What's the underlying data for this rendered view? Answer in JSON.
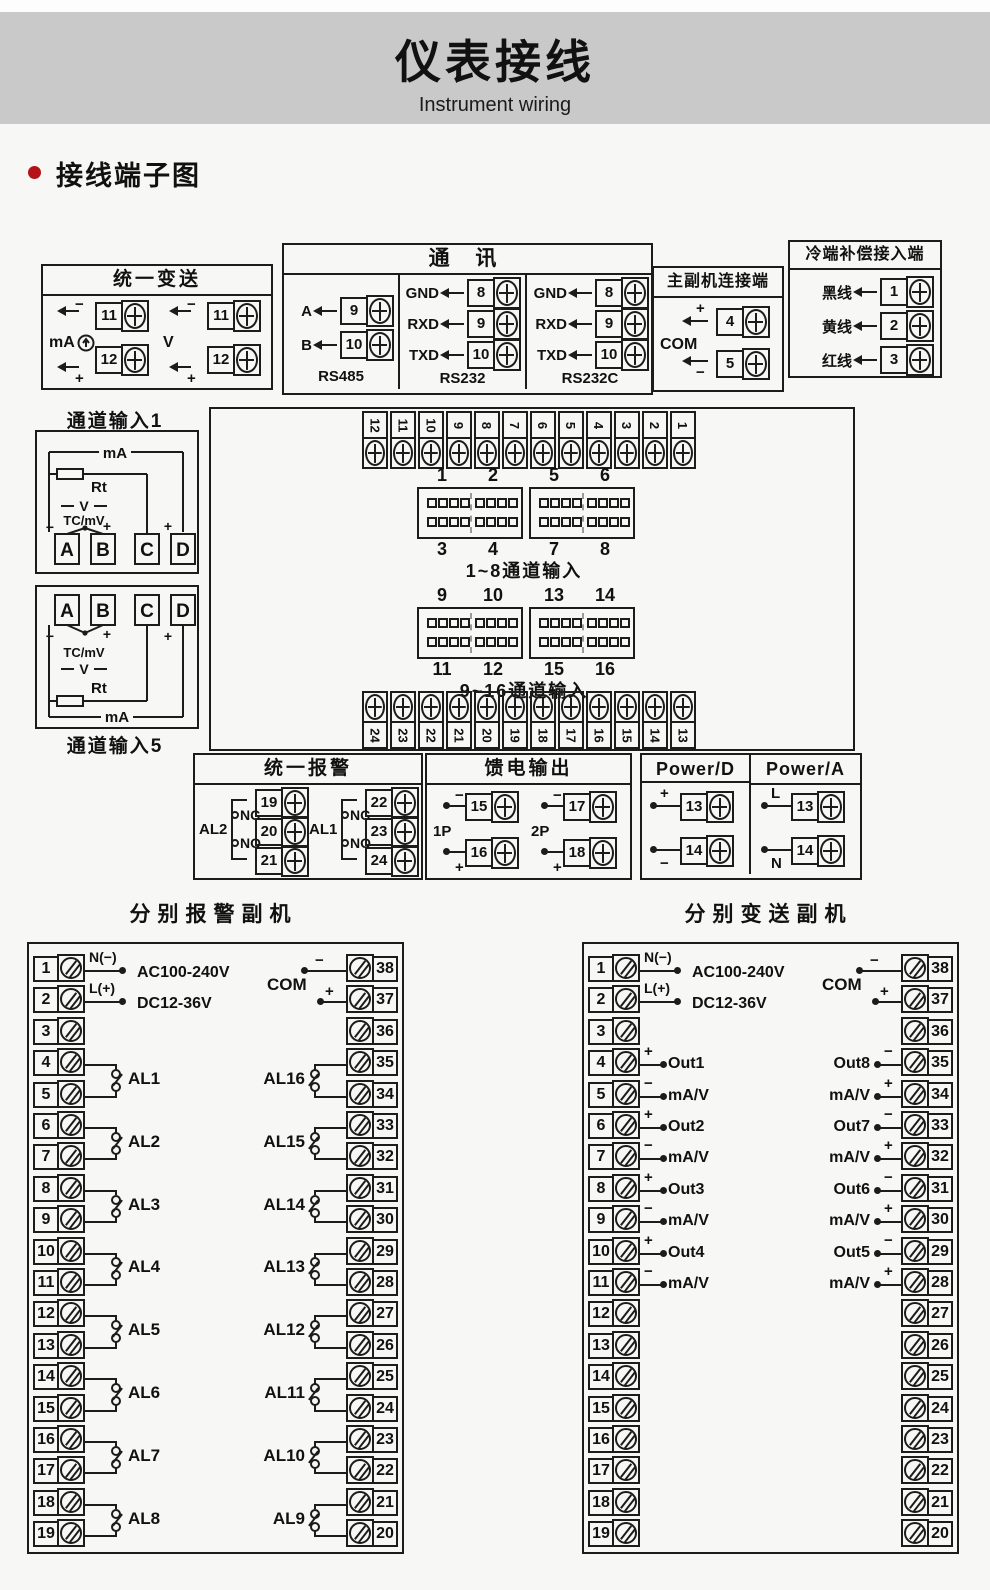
{
  "banner": {
    "title": "仪表接线",
    "subtitle": "Instrument wiring"
  },
  "section": {
    "heading": "接线端子图"
  },
  "colors": {
    "banner_bg": "#c9c9c9",
    "bullet_red": "#b51218",
    "line": "#1c1c1c",
    "page_bg": "#f7f7f5"
  },
  "boxes": {
    "unified_transmit": {
      "title": "统一变送",
      "circuits": [
        {
          "label": "mA",
          "minus": "−",
          "plus": "+",
          "terminals": [
            "11",
            "12"
          ]
        },
        {
          "label": "V",
          "minus": "−",
          "plus": "+",
          "terminals": [
            "11",
            "12"
          ]
        }
      ]
    },
    "comm": {
      "title": "通  讯",
      "cols": [
        {
          "caption": "RS485",
          "pins": [
            {
              "label": "A",
              "num": "9"
            },
            {
              "label": "B",
              "num": "10"
            }
          ]
        },
        {
          "caption": "RS232",
          "pins": [
            {
              "label": "GND",
              "num": "8"
            },
            {
              "label": "RXD",
              "num": "9"
            },
            {
              "label": "TXD",
              "num": "10"
            }
          ]
        },
        {
          "caption": "RS232C",
          "pins": [
            {
              "label": "GND",
              "num": "8"
            },
            {
              "label": "RXD",
              "num": "9"
            },
            {
              "label": "TXD",
              "num": "10"
            }
          ]
        }
      ]
    },
    "master_slave": {
      "title": "主副机连接端",
      "com": "COM",
      "pins": [
        {
          "sign": "+",
          "num": "4"
        },
        {
          "sign": "−",
          "num": "5"
        }
      ]
    },
    "cold_junction": {
      "title": "冷端补偿接入端",
      "pins": [
        {
          "label": "黑线",
          "num": "1"
        },
        {
          "label": "黄线",
          "num": "2"
        },
        {
          "label": "红线",
          "num": "3"
        }
      ]
    },
    "channel1": {
      "title": "通道输入1",
      "labels": {
        "mA": "mA",
        "Rt": "Rt",
        "V": "V",
        "TC": "TC/mV",
        "minus": "−",
        "plus": "+",
        "plusD": "+"
      },
      "terminals": [
        "A",
        "B",
        "C",
        "D"
      ]
    },
    "channel5": {
      "title": "通道输入5",
      "labels": {
        "mA": "mA",
        "Rt": "Rt",
        "V": "V",
        "TC": "TC/mV",
        "minus": "−",
        "plus": "+",
        "plusD": "+"
      },
      "terminals": [
        "A",
        "B",
        "C",
        "D"
      ]
    },
    "middle": {
      "top_strip": [
        "12",
        "11",
        "10",
        "9",
        "8",
        "7",
        "6",
        "5",
        "4",
        "3",
        "2",
        "1"
      ],
      "bottom_strip": [
        "24",
        "23",
        "22",
        "21",
        "20",
        "19",
        "18",
        "17",
        "16",
        "15",
        "14",
        "13"
      ],
      "group1": {
        "top_labels": [
          "1",
          "2",
          "5",
          "6"
        ],
        "bottom_labels": [
          "3",
          "4",
          "7",
          "8"
        ],
        "caption": "1~8通道输入"
      },
      "group2": {
        "top_labels": [
          "9",
          "10",
          "13",
          "14"
        ],
        "bottom_labels": [
          "11",
          "12",
          "15",
          "16"
        ],
        "caption": "9~16通道输入"
      }
    },
    "unified_alarm": {
      "title": "统一报警",
      "groups": [
        {
          "label": "AL2",
          "nc": "NC",
          "no": "NO",
          "terminals": [
            "19",
            "20",
            "21"
          ]
        },
        {
          "label": "AL1",
          "nc": "NC",
          "no": "NO",
          "terminals": [
            "22",
            "23",
            "24"
          ]
        }
      ]
    },
    "feed_output": {
      "title": "馈电输出",
      "groups": [
        {
          "label": "1P",
          "rows": [
            {
              "sign": "−",
              "num": "15"
            },
            {
              "sign": "+",
              "num": "16"
            }
          ]
        },
        {
          "label": "2P",
          "rows": [
            {
              "sign": "−",
              "num": "17"
            },
            {
              "sign": "+",
              "num": "18"
            }
          ]
        }
      ]
    },
    "power": {
      "columns": [
        {
          "title": "Power/D",
          "rows": [
            {
              "sign": "+",
              "num": "13"
            },
            {
              "sign": "−",
              "num": "14"
            }
          ]
        },
        {
          "title": "Power/A",
          "rows": [
            {
              "sign": "L",
              "num": "13"
            },
            {
              "sign": "N",
              "num": "14"
            }
          ]
        }
      ]
    }
  },
  "slave_alarm": {
    "title": "分别报警副机",
    "left_numbers": [
      "1",
      "2",
      "3",
      "4",
      "5",
      "6",
      "7",
      "8",
      "9",
      "10",
      "11",
      "12",
      "13",
      "14",
      "15",
      "16",
      "17",
      "18",
      "19"
    ],
    "right_numbers": [
      "38",
      "37",
      "36",
      "35",
      "34",
      "33",
      "32",
      "31",
      "30",
      "29",
      "28",
      "27",
      "26",
      "25",
      "24",
      "23",
      "22",
      "21",
      "20"
    ],
    "power": {
      "n": "N(−)",
      "l": "L(+)",
      "ac": "AC100-240V",
      "dc": "DC12-36V"
    },
    "com": {
      "label": "COM",
      "minus": "−",
      "plus": "+"
    },
    "left_groups": [
      {
        "label": "AL1",
        "row": 3
      },
      {
        "label": "AL2",
        "row": 5
      },
      {
        "label": "AL3",
        "row": 7
      },
      {
        "label": "AL4",
        "row": 9
      },
      {
        "label": "AL5",
        "row": 11
      },
      {
        "label": "AL6",
        "row": 13
      },
      {
        "label": "AL7",
        "row": 15
      },
      {
        "label": "AL8",
        "row": 17
      }
    ],
    "right_groups": [
      {
        "label": "AL16",
        "row": 3
      },
      {
        "label": "AL15",
        "row": 5
      },
      {
        "label": "AL14",
        "row": 7
      },
      {
        "label": "AL13",
        "row": 9
      },
      {
        "label": "AL12",
        "row": 11
      },
      {
        "label": "AL11",
        "row": 13
      },
      {
        "label": "AL10",
        "row": 15
      },
      {
        "label": "AL9",
        "row": 17
      }
    ]
  },
  "slave_transmit": {
    "title": "分别变送副机",
    "left_numbers": [
      "1",
      "2",
      "3",
      "4",
      "5",
      "6",
      "7",
      "8",
      "9",
      "10",
      "11",
      "12",
      "13",
      "14",
      "15",
      "16",
      "17",
      "18",
      "19"
    ],
    "right_numbers": [
      "38",
      "37",
      "36",
      "35",
      "34",
      "33",
      "32",
      "31",
      "30",
      "29",
      "28",
      "27",
      "26",
      "25",
      "24",
      "23",
      "22",
      "21",
      "20"
    ],
    "power": {
      "n": "N(−)",
      "l": "L(+)",
      "ac": "AC100-240V",
      "dc": "DC12-36V"
    },
    "com": {
      "label": "COM",
      "minus": "−",
      "plus": "+"
    },
    "left_pins": [
      {
        "row": 3,
        "sign": "+",
        "label": "Out1"
      },
      {
        "row": 4,
        "sign": "−",
        "label": "mA/V"
      },
      {
        "row": 5,
        "sign": "+",
        "label": "Out2"
      },
      {
        "row": 6,
        "sign": "−",
        "label": "mA/V"
      },
      {
        "row": 7,
        "sign": "+",
        "label": "Out3"
      },
      {
        "row": 8,
        "sign": "−",
        "label": "mA/V"
      },
      {
        "row": 9,
        "sign": "+",
        "label": "Out4"
      },
      {
        "row": 10,
        "sign": "−",
        "label": "mA/V"
      }
    ],
    "right_pins": [
      {
        "row": 3,
        "sign": "−",
        "label": "Out8"
      },
      {
        "row": 4,
        "sign": "+",
        "label": "mA/V"
      },
      {
        "row": 5,
        "sign": "−",
        "label": "Out7"
      },
      {
        "row": 6,
        "sign": "+",
        "label": "mA/V"
      },
      {
        "row": 7,
        "sign": "−",
        "label": "Out6"
      },
      {
        "row": 8,
        "sign": "+",
        "label": "mA/V"
      },
      {
        "row": 9,
        "sign": "−",
        "label": "Out5"
      },
      {
        "row": 10,
        "sign": "+",
        "label": "mA/V"
      }
    ]
  }
}
